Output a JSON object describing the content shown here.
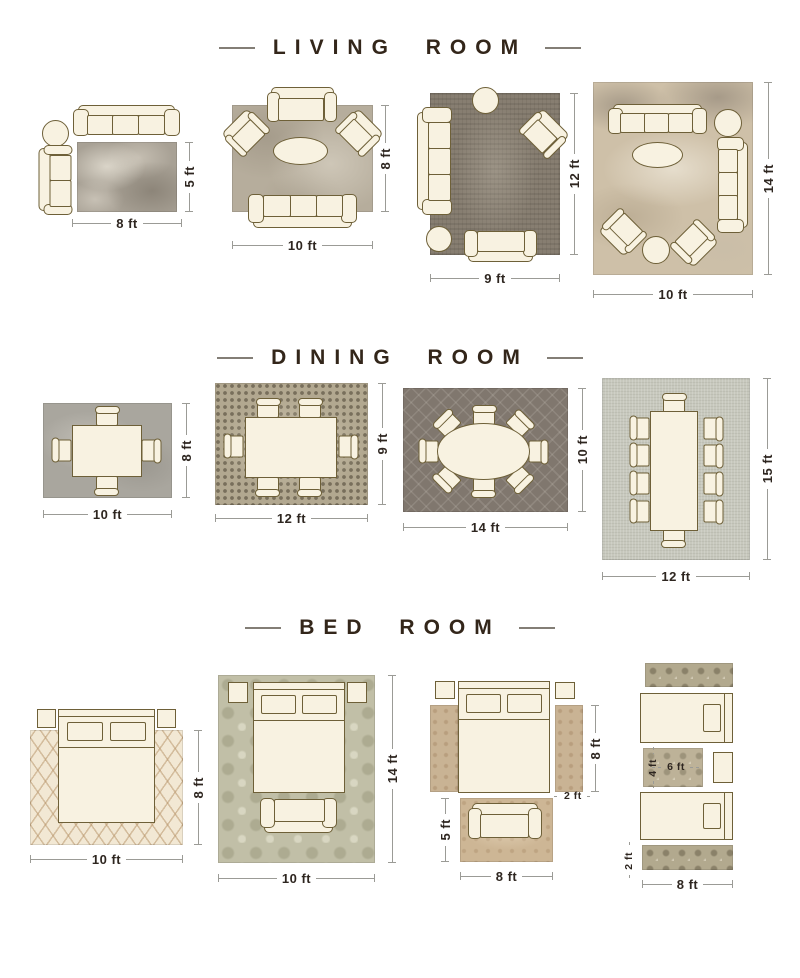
{
  "page": {
    "background": "#ffffff"
  },
  "colors": {
    "title_text": "#33261a",
    "dimension_text": "#2e2620",
    "dimension_line": "#9b9b96",
    "furniture_fill": "#f8f2e1",
    "furniture_outline": "#6e6038"
  },
  "sections": [
    {
      "title": "LIVING ROOM",
      "layouts": [
        {
          "width_label": "8 ft",
          "height_label": "5 ft"
        },
        {
          "width_label": "10 ft",
          "height_label": "8 ft"
        },
        {
          "width_label": "9 ft",
          "height_label": "12 ft"
        },
        {
          "width_label": "10 ft",
          "height_label": "14 ft"
        }
      ]
    },
    {
      "title": "DINING ROOM",
      "layouts": [
        {
          "width_label": "10 ft",
          "height_label": "8 ft"
        },
        {
          "width_label": "12 ft",
          "height_label": "9 ft"
        },
        {
          "width_label": "14 ft",
          "height_label": "10 ft"
        },
        {
          "width_label": "12 ft",
          "height_label": "15 ft"
        }
      ]
    },
    {
      "title": "BED ROOM",
      "layouts": [
        {
          "width_label": "10 ft",
          "height_label": "8 ft"
        },
        {
          "width_label": "10 ft",
          "height_label": "14 ft"
        },
        {
          "runner_length_label": "8 ft",
          "runner_width_label": "2 ft",
          "foot_rug_height_label": "5 ft",
          "foot_rug_width_label": "8 ft"
        },
        {
          "between_rug_height_label": "4 ft",
          "between_rug_width_label": "6 ft",
          "runner_width_label": "2 ft",
          "runner_length_label": "8 ft"
        }
      ]
    }
  ]
}
